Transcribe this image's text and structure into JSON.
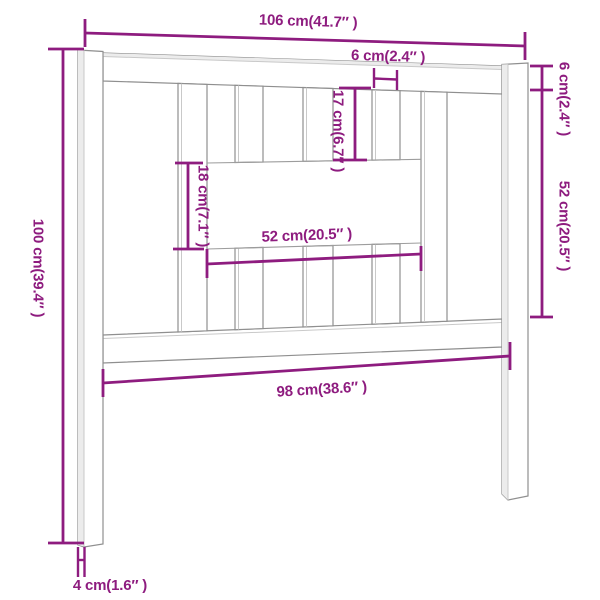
{
  "diagram": {
    "object": "bed headboard dimension drawing",
    "units": "cm (inches)",
    "dimensions": {
      "overall_width": {
        "label": "106 cm(41.7″ )",
        "value_cm": 106,
        "value_in": 41.7,
        "measures": "total width across top"
      },
      "slat_width": {
        "label": "6 cm(2.4″ )",
        "value_cm": 6,
        "value_in": 2.4,
        "measures": "width of one vertical slat"
      },
      "top_rail_height": {
        "label": "6 cm(2.4″ )",
        "value_cm": 6,
        "value_in": 2.4,
        "measures": "height of top rail (right side)"
      },
      "right_inner_height": {
        "label": "52 cm(20.5″ )",
        "value_cm": 52,
        "value_in": 20.5,
        "measures": "inner height between rails (right side)"
      },
      "left_height": {
        "label": "100 cm(39.4″ )",
        "value_cm": 100,
        "value_in": 39.4,
        "measures": "total height (left side)"
      },
      "upper_slat_length": {
        "label": "17 cm(6.7″ )",
        "value_cm": 17,
        "value_in": 6.7,
        "measures": "upper slat length above opening"
      },
      "opening_height": {
        "label": "18 cm(7.1″ )",
        "value_cm": 18,
        "value_in": 7.1,
        "measures": "height of central opening"
      },
      "opening_width": {
        "label": "52 cm(20.5″ )",
        "value_cm": 52,
        "value_in": 20.5,
        "measures": "width of central opening"
      },
      "inner_width": {
        "label": "98 cm(38.6″ )",
        "value_cm": 98,
        "value_in": 38.6,
        "measures": "inner width between legs"
      },
      "leg_width": {
        "label": "4 cm(1.6″ )",
        "value_cm": 4,
        "value_in": 1.6,
        "measures": "leg thickness at bottom"
      }
    },
    "colors": {
      "dimension_line": "#8e1c7f",
      "drawing_line": "#8f8f8f",
      "background": "#ffffff"
    }
  }
}
